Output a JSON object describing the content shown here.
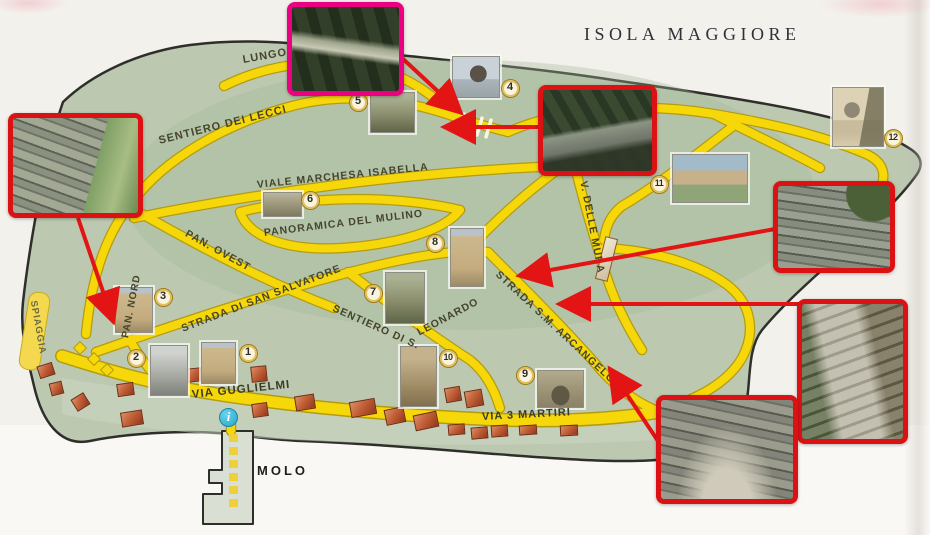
{
  "title": "ISOLA MAGGIORE",
  "info": {
    "glyph": "i"
  },
  "colors": {
    "island": "#bcc9b0",
    "road": "#f6d70a",
    "road_edge": "#b39b10",
    "coastline": "#2e2e2a",
    "frame_red": "#dc1114",
    "frame_pink": "#ea0080",
    "arrow_red": "#e21414",
    "marker_ring": "#9c7a1e",
    "marker_fill": "#fbf4dd",
    "building_brick": "#bf5b36",
    "info_cyan": "#35b6dc",
    "background": "#f3f1ec"
  },
  "streets": [
    {
      "id": "lungo",
      "label": "LUNGO",
      "x": 243,
      "y": 55,
      "rot": -10,
      "s": 11
    },
    {
      "id": "sentiero-dei-lecci",
      "label": "SENTIERO DEI LECCI",
      "x": 159,
      "y": 136,
      "rot": -14,
      "s": 11
    },
    {
      "id": "viale-marchesa-isabella",
      "label": "VIALE MARCHESA ISABELLA",
      "x": 257,
      "y": 180,
      "rot": -6,
      "s": 10.5
    },
    {
      "id": "panoramica-del-mulino",
      "label": "PANORAMICA DEL MULINO",
      "x": 264,
      "y": 228,
      "rot": -7,
      "s": 10.5
    },
    {
      "id": "pan-ovest",
      "label": "PAN. OVEST",
      "x": 186,
      "y": 228,
      "rot": 29,
      "s": 10.5
    },
    {
      "id": "pan-nord",
      "label": "PAN. NORD",
      "x": 126,
      "y": 333,
      "rot": -79,
      "s": 10
    },
    {
      "id": "strada-di-san-salvatore",
      "label": "STRADA DI SAN SALVATORE",
      "x": 182,
      "y": 324,
      "rot": -21,
      "s": 10.5
    },
    {
      "id": "sentiero-di-s",
      "label": "SENTIERO DI S.",
      "x": 333,
      "y": 303,
      "rot": 24,
      "s": 10.5
    },
    {
      "id": "leonardo",
      "label": "LEONARDO",
      "x": 418,
      "y": 328,
      "rot": -28,
      "s": 10.5
    },
    {
      "id": "strada-sm-arcangelo",
      "label": "STRADA S.M. ARCANGELO",
      "x": 497,
      "y": 268,
      "rot": 43,
      "s": 10.5
    },
    {
      "id": "v-delle-mura",
      "label": "V. DELLE MURA",
      "x": 583,
      "y": 176,
      "rot": 79,
      "s": 10.5
    },
    {
      "id": "via-guglielmi",
      "label": "VIA GUGLIELMI",
      "x": 192,
      "y": 390,
      "rot": -6,
      "s": 11.5
    },
    {
      "id": "via-3-martiri",
      "label": "VIA 3 MARTIRI",
      "x": 482,
      "y": 412,
      "rot": -3,
      "s": 11
    },
    {
      "id": "molo",
      "label": "MOLO",
      "x": 257,
      "y": 464,
      "rot": 0,
      "s": 13
    },
    {
      "id": "spiaggia",
      "label": "SPIAGGIA",
      "x": 33,
      "y": 296,
      "rot": 80,
      "s": 9.5
    }
  ],
  "markers": [
    {
      "n": "1",
      "x": 248,
      "y": 353
    },
    {
      "n": "2",
      "x": 136,
      "y": 358
    },
    {
      "n": "3",
      "x": 163,
      "y": 297
    },
    {
      "n": "4",
      "x": 510,
      "y": 88
    },
    {
      "n": "5",
      "x": 358,
      "y": 102
    },
    {
      "n": "6",
      "x": 310,
      "y": 200
    },
    {
      "n": "7",
      "x": 373,
      "y": 293
    },
    {
      "n": "8",
      "x": 435,
      "y": 243
    },
    {
      "n": "9",
      "x": 525,
      "y": 375
    },
    {
      "n": "10",
      "x": 448,
      "y": 358
    },
    {
      "n": "11",
      "x": 659,
      "y": 184
    },
    {
      "n": "12",
      "x": 893,
      "y": 138
    }
  ],
  "photos": [
    {
      "id": "photo-site-5",
      "x": 370,
      "y": 92,
      "w": 45,
      "h": 41,
      "kind": "ruin"
    },
    {
      "id": "photo-site-4",
      "x": 452,
      "y": 56,
      "w": 48,
      "h": 42,
      "kind": "statue"
    },
    {
      "id": "photo-site-12",
      "x": 832,
      "y": 87,
      "w": 52,
      "h": 60,
      "kind": "tower-water"
    },
    {
      "id": "photo-site-11",
      "x": 672,
      "y": 154,
      "w": 76,
      "h": 49,
      "kind": "aerial"
    },
    {
      "id": "photo-site-6",
      "x": 263,
      "y": 192,
      "w": 39,
      "h": 25,
      "kind": "ruin-low"
    },
    {
      "id": "photo-site-8",
      "x": 450,
      "y": 228,
      "w": 34,
      "h": 59,
      "kind": "church"
    },
    {
      "id": "photo-site-7",
      "x": 385,
      "y": 272,
      "w": 40,
      "h": 52,
      "kind": "ruin"
    },
    {
      "id": "photo-site-3",
      "x": 115,
      "y": 287,
      "w": 38,
      "h": 46,
      "kind": "church"
    },
    {
      "id": "photo-site-2",
      "x": 150,
      "y": 345,
      "w": 38,
      "h": 51,
      "kind": "grey-building"
    },
    {
      "id": "photo-site-1",
      "x": 201,
      "y": 342,
      "w": 35,
      "h": 42,
      "kind": "church"
    },
    {
      "id": "photo-site-10",
      "x": 400,
      "y": 346,
      "w": 37,
      "h": 61,
      "kind": "street"
    },
    {
      "id": "photo-site-9",
      "x": 537,
      "y": 370,
      "w": 47,
      "h": 38,
      "kind": "stone-arch"
    }
  ],
  "insets": [
    {
      "id": "inset-wall-northwest",
      "x": 8,
      "y": 113,
      "w": 135,
      "h": 105,
      "frame": "red",
      "kind": "wall-path"
    },
    {
      "id": "inset-wall-top",
      "x": 287,
      "y": 2,
      "w": 117,
      "h": 94,
      "frame": "pink",
      "kind": "forest-log"
    },
    {
      "id": "inset-wall-north",
      "x": 538,
      "y": 85,
      "w": 119,
      "h": 91,
      "frame": "red",
      "kind": "forest-wall"
    },
    {
      "id": "inset-wall-east",
      "x": 773,
      "y": 181,
      "w": 122,
      "h": 92,
      "frame": "red",
      "kind": "wall-green"
    },
    {
      "id": "inset-path-southeast",
      "x": 797,
      "y": 299,
      "w": 111,
      "h": 145,
      "frame": "red",
      "kind": "stone-path"
    },
    {
      "id": "inset-wall-south",
      "x": 656,
      "y": 395,
      "w": 142,
      "h": 109,
      "frame": "red",
      "kind": "wall-curve"
    }
  ],
  "arrows": [
    {
      "x1": 78,
      "y1": 218,
      "x2": 112,
      "y2": 318
    },
    {
      "x1": 402,
      "y1": 58,
      "x2": 458,
      "y2": 110
    },
    {
      "x1": 540,
      "y1": 127,
      "x2": 448,
      "y2": 127
    },
    {
      "x1": 775,
      "y1": 229,
      "x2": 523,
      "y2": 275
    },
    {
      "x1": 799,
      "y1": 304,
      "x2": 563,
      "y2": 304
    },
    {
      "x1": 662,
      "y1": 447,
      "x2": 612,
      "y2": 372
    }
  ],
  "buildings": [
    [
      38,
      364,
      16,
      13,
      -18
    ],
    [
      50,
      382,
      13,
      13,
      -14
    ],
    [
      73,
      395,
      15,
      14,
      -32
    ],
    [
      117,
      383,
      17,
      13,
      -8
    ],
    [
      121,
      411,
      22,
      15,
      -9
    ],
    [
      186,
      368,
      16,
      14,
      -6
    ],
    [
      251,
      366,
      16,
      16,
      -6
    ],
    [
      252,
      403,
      16,
      14,
      -8
    ],
    [
      295,
      395,
      20,
      15,
      -9
    ],
    [
      350,
      400,
      26,
      16,
      -10
    ],
    [
      385,
      408,
      20,
      16,
      -12
    ],
    [
      414,
      413,
      24,
      16,
      -12
    ],
    [
      445,
      387,
      16,
      15,
      -10
    ],
    [
      465,
      390,
      18,
      17,
      -10
    ],
    [
      448,
      424,
      17,
      11,
      -5
    ],
    [
      471,
      427,
      17,
      12,
      -5
    ],
    [
      491,
      425,
      17,
      12,
      -4
    ],
    [
      519,
      425,
      18,
      10,
      -4
    ],
    [
      560,
      425,
      18,
      11,
      -3
    ]
  ],
  "hall_building": {
    "x": 600,
    "y": 237,
    "w": 13,
    "h": 44,
    "r": 14
  }
}
